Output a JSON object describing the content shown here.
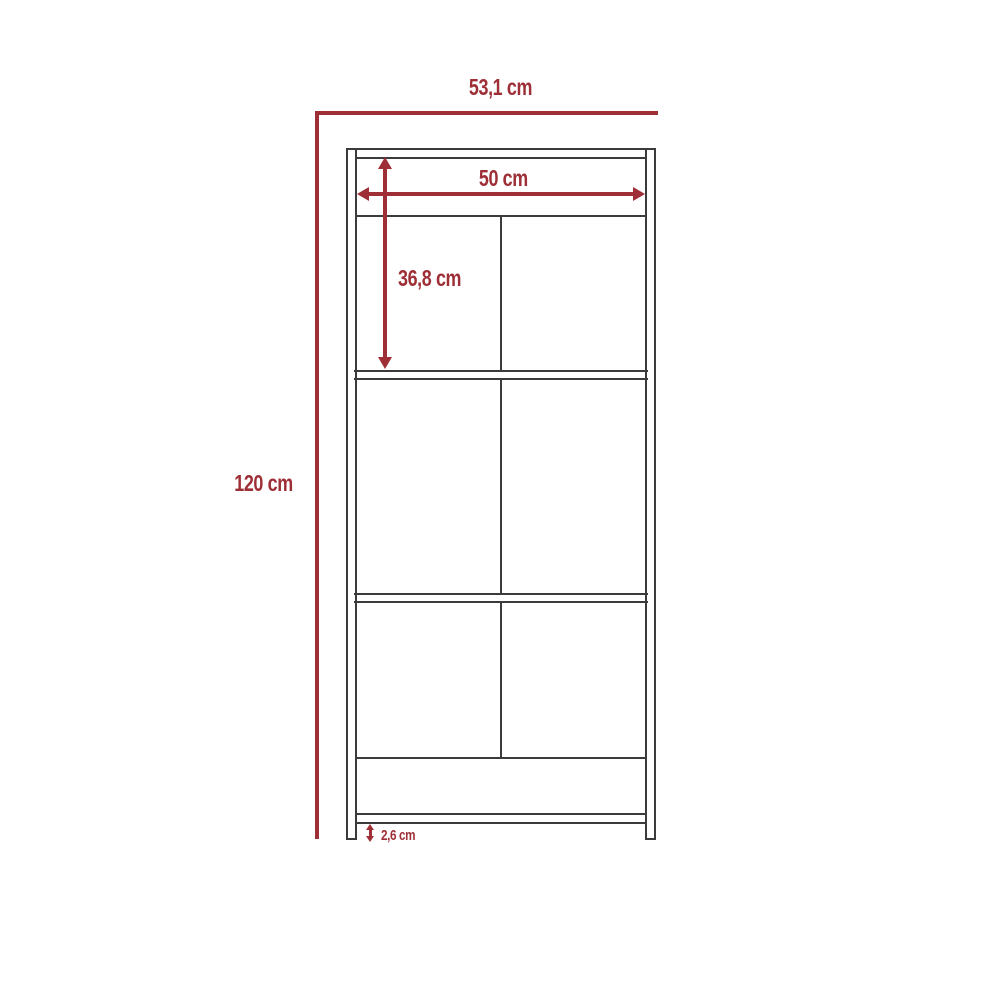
{
  "diagram": {
    "type": "furniture-dimension-drawing",
    "subject": "tall cabinet / bookcase front elevation with dimension annotations",
    "background": "#ffffff",
    "colors": {
      "dimension": "#9E2F37",
      "outline": "#3B3B3B"
    },
    "labels": {
      "outer_width": "53,1 cm",
      "total_height": "120 cm",
      "inner_width": "50 cm",
      "top_section_height": "36,8 cm",
      "base_clearance": "2,6 cm"
    }
  }
}
